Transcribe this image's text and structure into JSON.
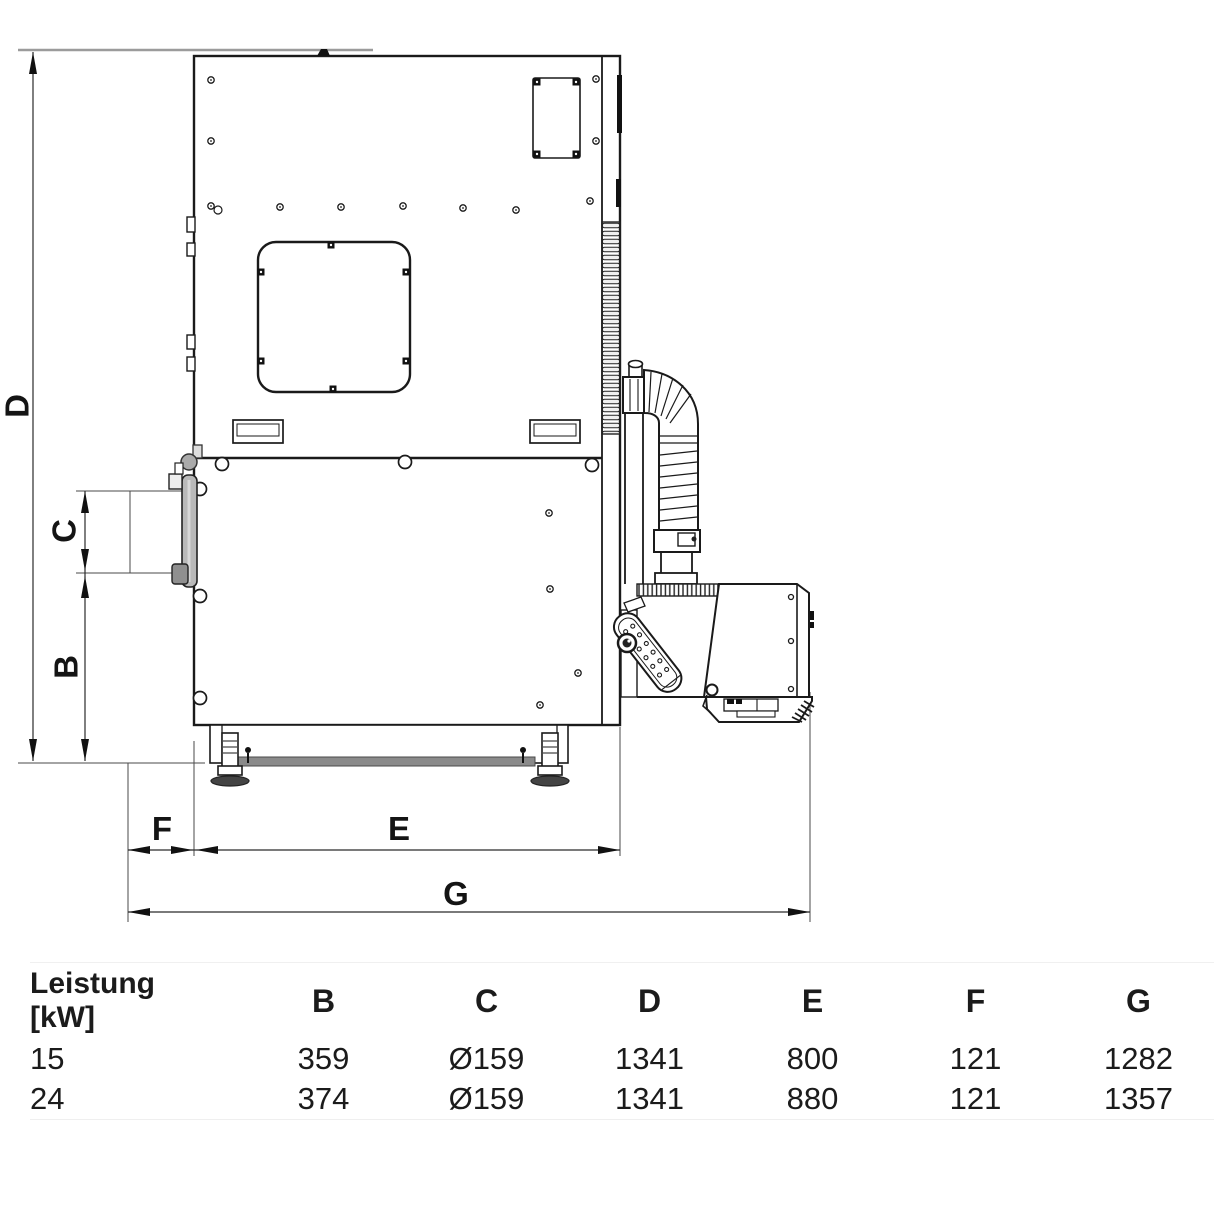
{
  "dimensions": {
    "d": "D",
    "c": "C",
    "b": "B",
    "f": "F",
    "e": "E",
    "g": "G"
  },
  "table": {
    "row_header": {
      "line1": "Leistung",
      "line2": "[kW]"
    },
    "columns": [
      "B",
      "C",
      "D",
      "E",
      "F",
      "G"
    ],
    "rows": [
      {
        "power": "15",
        "values": [
          "359",
          "Ø159",
          "1341",
          "800",
          "121",
          "1282"
        ]
      },
      {
        "power": "24",
        "values": [
          "374",
          "Ø159",
          "1341",
          "880",
          "121",
          "1357"
        ]
      }
    ]
  },
  "colors": {
    "line": "#1a1a1a",
    "dim_line": "#2b2b2b",
    "ext_gray": "#9b9b9b",
    "base_bar": "#8a8a8a",
    "flange_gray": "#b9b9b9"
  }
}
